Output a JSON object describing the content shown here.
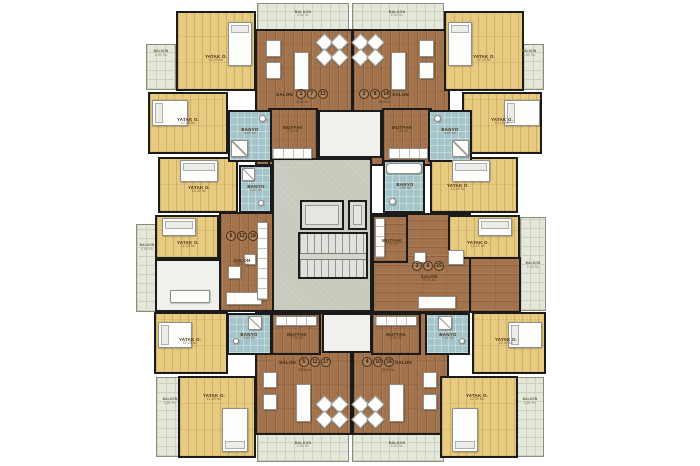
{
  "plan": {
    "room_labels": {
      "salon": {
        "name": "SALON",
        "area": "28.50 m²"
      },
      "bedroom": {
        "name": "YATAK O.",
        "area": "12.20 m²"
      },
      "bathroom": {
        "name": "BANYO",
        "area": "4.60 m²"
      },
      "kitchen": {
        "name": "MUTFAK",
        "area": "7.90 m²"
      },
      "balcony": {
        "name": "BALKON",
        "area": "6.80 m²"
      }
    },
    "units": [
      {
        "id": "unit-1-7-13",
        "numbers": [
          "1",
          "7",
          "13"
        ]
      },
      {
        "id": "unit-2-8-14",
        "numbers": [
          "2",
          "8",
          "14"
        ]
      },
      {
        "id": "unit-3-9-15",
        "numbers": [
          "3",
          "9",
          "15"
        ]
      },
      {
        "id": "unit-4-10-16",
        "numbers": [
          "4",
          "10",
          "16"
        ]
      },
      {
        "id": "unit-5-11-17",
        "numbers": [
          "5",
          "11",
          "17"
        ]
      },
      {
        "id": "unit-6-12-18",
        "numbers": [
          "6",
          "12",
          "18"
        ]
      }
    ],
    "colors": {
      "wall": "#1b1b1b",
      "salon_wood": "#a2734c",
      "bedroom_wood": "#e7cb81",
      "bathroom": "#a4c4ca",
      "balcony": "#e5e7da",
      "core": "#c7cabc"
    }
  }
}
